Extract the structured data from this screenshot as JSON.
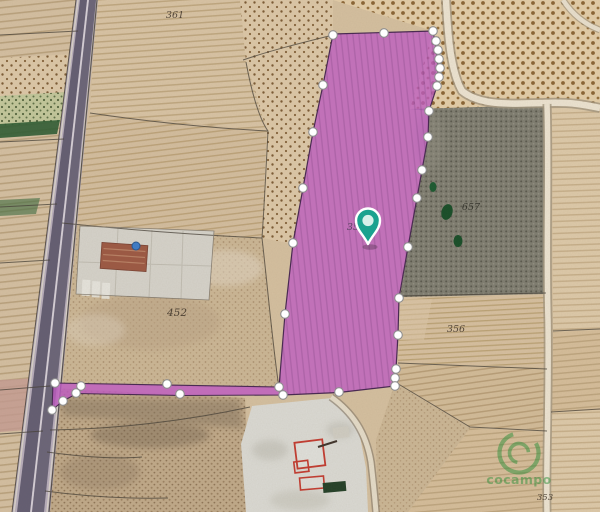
{
  "map": {
    "labels": {
      "field_topleft": "361",
      "field_left": "452",
      "field_right_upper": "657",
      "field_right_mid": "356",
      "field_bottom_right": "353",
      "selected_parcel_number": "35"
    },
    "selected_parcel": {
      "fill_color": "#bd5cc0",
      "outline_color": "#4a2b52",
      "vertex_color": "#ffffff"
    },
    "icons": {
      "pin": "location-pin-icon",
      "watermark_logo": "cocampo-logo-icon"
    },
    "pin": {
      "color": "#1ba28f"
    },
    "watermark": {
      "text": "cocampo",
      "color": "#2f8f3a"
    }
  }
}
